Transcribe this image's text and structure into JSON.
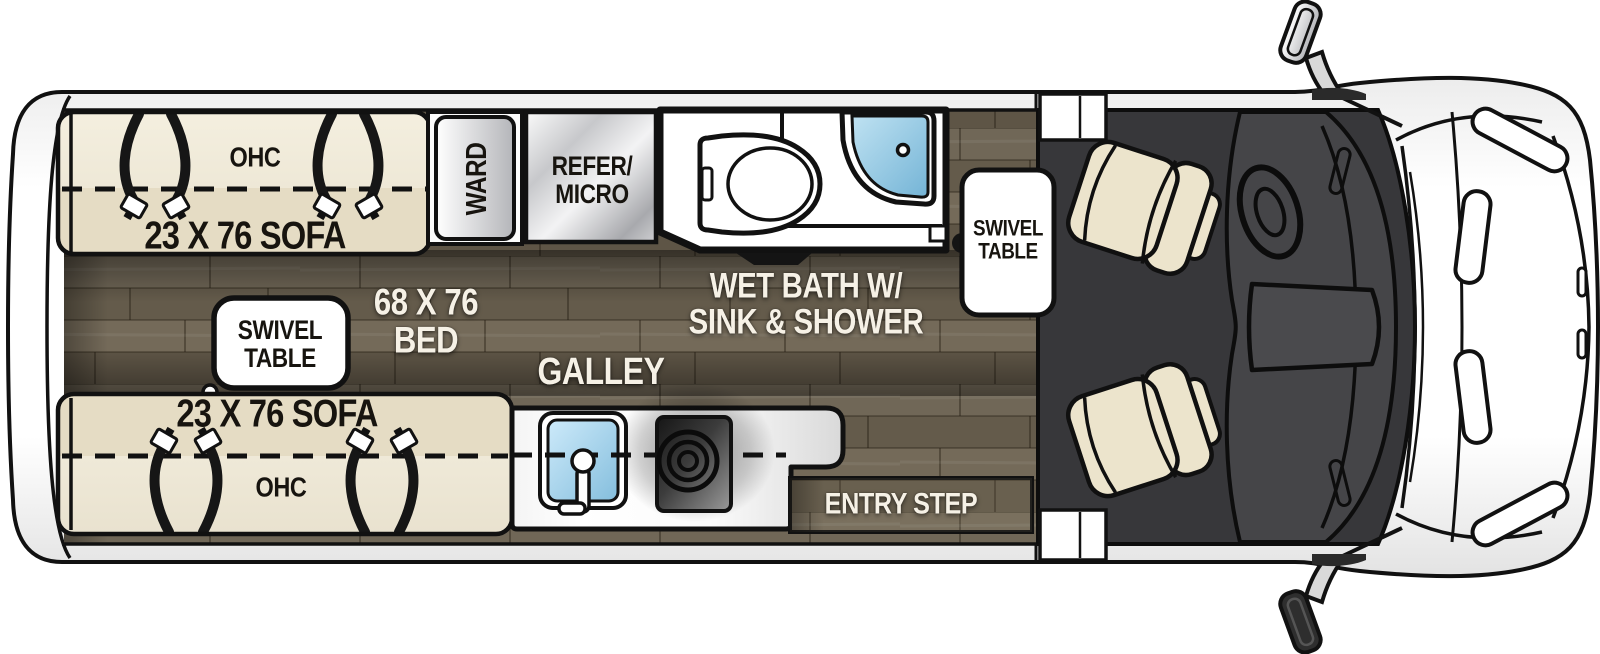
{
  "floorplan": {
    "labels": {
      "ohc_top": "OHC",
      "sofa_top": "23 X 76 SOFA",
      "ward": "WARD",
      "refer_micro": "REFER/\nMICRO",
      "wet_bath": "WET BATH W/\nSINK & SHOWER",
      "swivel_table_front": "SWIVEL\nTABLE",
      "swivel_table_rear": "SWIVEL\nTABLE",
      "bed": "68 X 76\nBED",
      "sofa_bottom": "23 X 76 SOFA",
      "ohc_bottom": "OHC",
      "galley": "GALLEY",
      "entry_step": "ENTRY STEP"
    },
    "colors": {
      "wood_floor": "#6a6151",
      "sofa_cream": "#efe9d8",
      "cab_charcoal": "#3a3a3c",
      "shower_blue": "#8fc7e4",
      "sink_blue": "#a9d9f0",
      "counter_white": "#ffffff",
      "outline_black": "#111111"
    },
    "icons": {
      "toilet": "toilet-icon",
      "corner_shower": "shower-icon",
      "galley_sink": "sink-icon",
      "stove_burner": "stove-icon",
      "seatbelts": "seatbelt-icon",
      "cab_seats": "captain-chair-icon",
      "side_mirrors": "mirror-icon",
      "steering_wheel": "steering-wheel-icon"
    }
  }
}
